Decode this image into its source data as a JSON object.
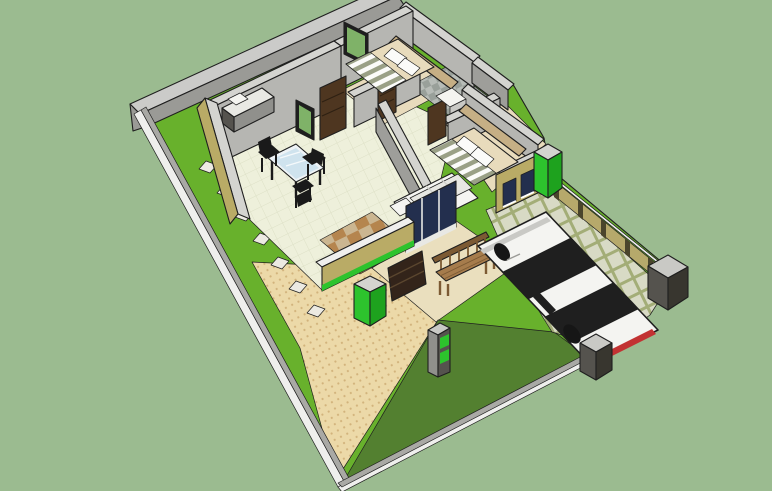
{
  "app": {
    "title": "3D house plan model — isometric view"
  },
  "colors": {
    "edge": "#1f1f1f",
    "sage": "#9bbb90",
    "lawn": "#68b12c",
    "lawnDark": "#538030",
    "walkway": "#ecd9a8",
    "walkwayDot": "#d2b37c",
    "porch": "#eadfbe",
    "paverBase": "#a3ad77",
    "paverStone": "#d8dac5",
    "stoneFill": "#eceae2",
    "boundaryTop": "#cbcbc9",
    "boundaryFace": "#9a9a96",
    "curbTop": "#efefed",
    "curbFace": "#a9a9a5",
    "fenceOlive": "#b6a96b",
    "fenceRail": "#f0f0ee",
    "fencePost": "#4a452c",
    "wallCap": "#d4d4d0",
    "wallFace": "#b6b6b2",
    "wallShadow": "#9e9e9a",
    "olive": "#b9ab66",
    "greenAccent": "#2dc32d",
    "greenAccentDark": "#1ea21e",
    "floorCream": "#eef0db",
    "floorLine": "#dde0c6",
    "rugA": "#b5854e",
    "rugB": "#cbb691",
    "bathA": "#b7bcb7",
    "bathB": "#99a09a",
    "wood": "#4e3620",
    "woodLine": "#2e2012",
    "headboard": "#c6af85",
    "mattress": "#e8dbbc",
    "stripeOlive": "#9aa086",
    "pillow": "#fbfbf9",
    "navyGlass": "#232f4e",
    "greenGlass": "#7fb268",
    "tableGlass": "#cfe3ee",
    "tableFrame": "#eef3f6",
    "chairBlack": "#1a1a1a",
    "sofa": "#f5f5f2",
    "sofaShade": "#e7e7e2",
    "benchWood": "#a67c4c",
    "benchDark": "#7c5a33",
    "slatPanel": "#33241a",
    "slatLine": "#5a462e",
    "car": "#f4f4f1",
    "carGlass": "#1f1f1f",
    "carTrim": "#c9c9c5",
    "tire": "#161616",
    "taillight": "#c23232",
    "postTop": "#c9c9c5",
    "postFaceA": "#55534e",
    "postFaceB": "#38362f",
    "marble": "#e9e9e4",
    "cabinet": "#90908c",
    "tub": "#f4f4f0"
  },
  "scene": {
    "view": "isometric 3D model of a single-storey house on a walled rectangular plot",
    "ground_areas": [
      "lawn",
      "dark-front-lawn",
      "dotted-paved-walkway",
      "porch-slab",
      "paver-driveway"
    ],
    "boundary": [
      "tall-back-wall",
      "low-white-curbs",
      "olive-fence-with-posts",
      "corner-pillar",
      "gate-posts"
    ],
    "rooms": [
      "living-dining-room",
      "kitchenette",
      "hallway",
      "bathroom",
      "bedroom-1",
      "bedroom-2"
    ],
    "furniture": [
      "bed-1",
      "bed-2",
      "white-sofa",
      "ottoman",
      "glass-dining-table",
      "dining-chairs",
      "kitchen-counter",
      "bathtub",
      "garden-bench",
      "mailbox-post",
      "slatted-cabinet"
    ],
    "vehicle": "white-sedan",
    "counts": {
      "stepping_stones": 7,
      "fence_posts": 5,
      "dining_chairs": 3,
      "gate_posts": 2,
      "bedrooms": 2,
      "bedroom2_windows": 2
    }
  }
}
